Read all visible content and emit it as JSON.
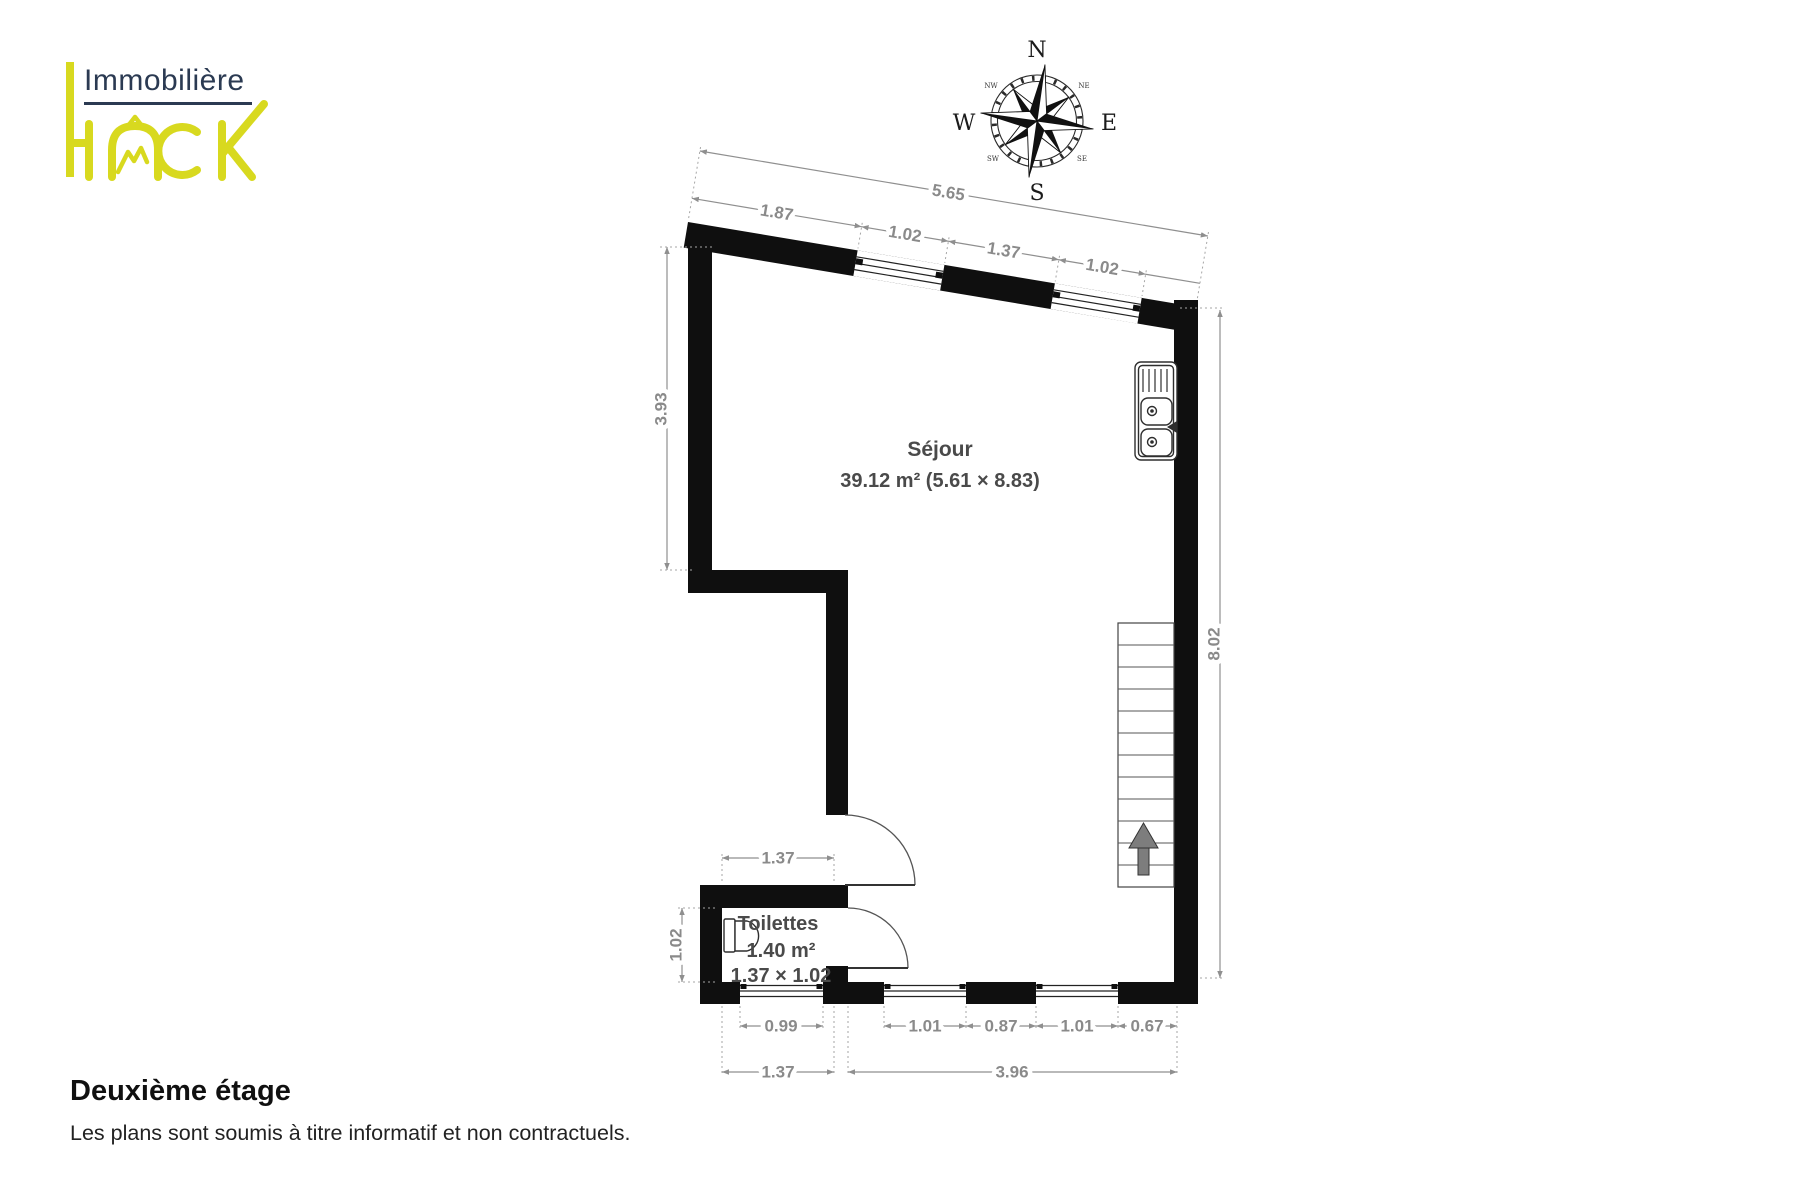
{
  "branding": {
    "immobiliere": "Immobilière",
    "hack": "HACK"
  },
  "compass": {
    "n": "N",
    "e": "E",
    "s": "S",
    "w": "W",
    "nw": "NW",
    "ne": "NE",
    "sw": "SW",
    "se": "SE"
  },
  "rooms": {
    "sejour": {
      "name": "Séjour",
      "area": "39.12 m² (5.61 × 8.83)"
    },
    "toilettes": {
      "name": "Toilettes",
      "area": "1.40 m²",
      "dims": "1.37 × 1.02"
    }
  },
  "dims": {
    "top_total": "5.65",
    "top": [
      "1.87",
      "1.02",
      "1.37",
      "1.02"
    ],
    "left": "3.93",
    "right": "8.02",
    "toilettes_w": "1.37",
    "toilettes_h": "1.02",
    "bottom_windows": [
      "0.99",
      "1.01",
      "0.87",
      "1.01",
      "0.67"
    ],
    "bottom_totals": [
      "1.37",
      "3.96"
    ]
  },
  "footer": {
    "title": "Deuxième étage",
    "disclaimer": "Les plans sont soumis à titre informatif et non contractuels."
  },
  "colors": {
    "wall": "#0f0f0f",
    "dimension": "#8f8f8f",
    "brand_yellow": "#d8d91f",
    "brand_navy": "#2b3a52",
    "stair_arrow": "#7d7d7d"
  }
}
